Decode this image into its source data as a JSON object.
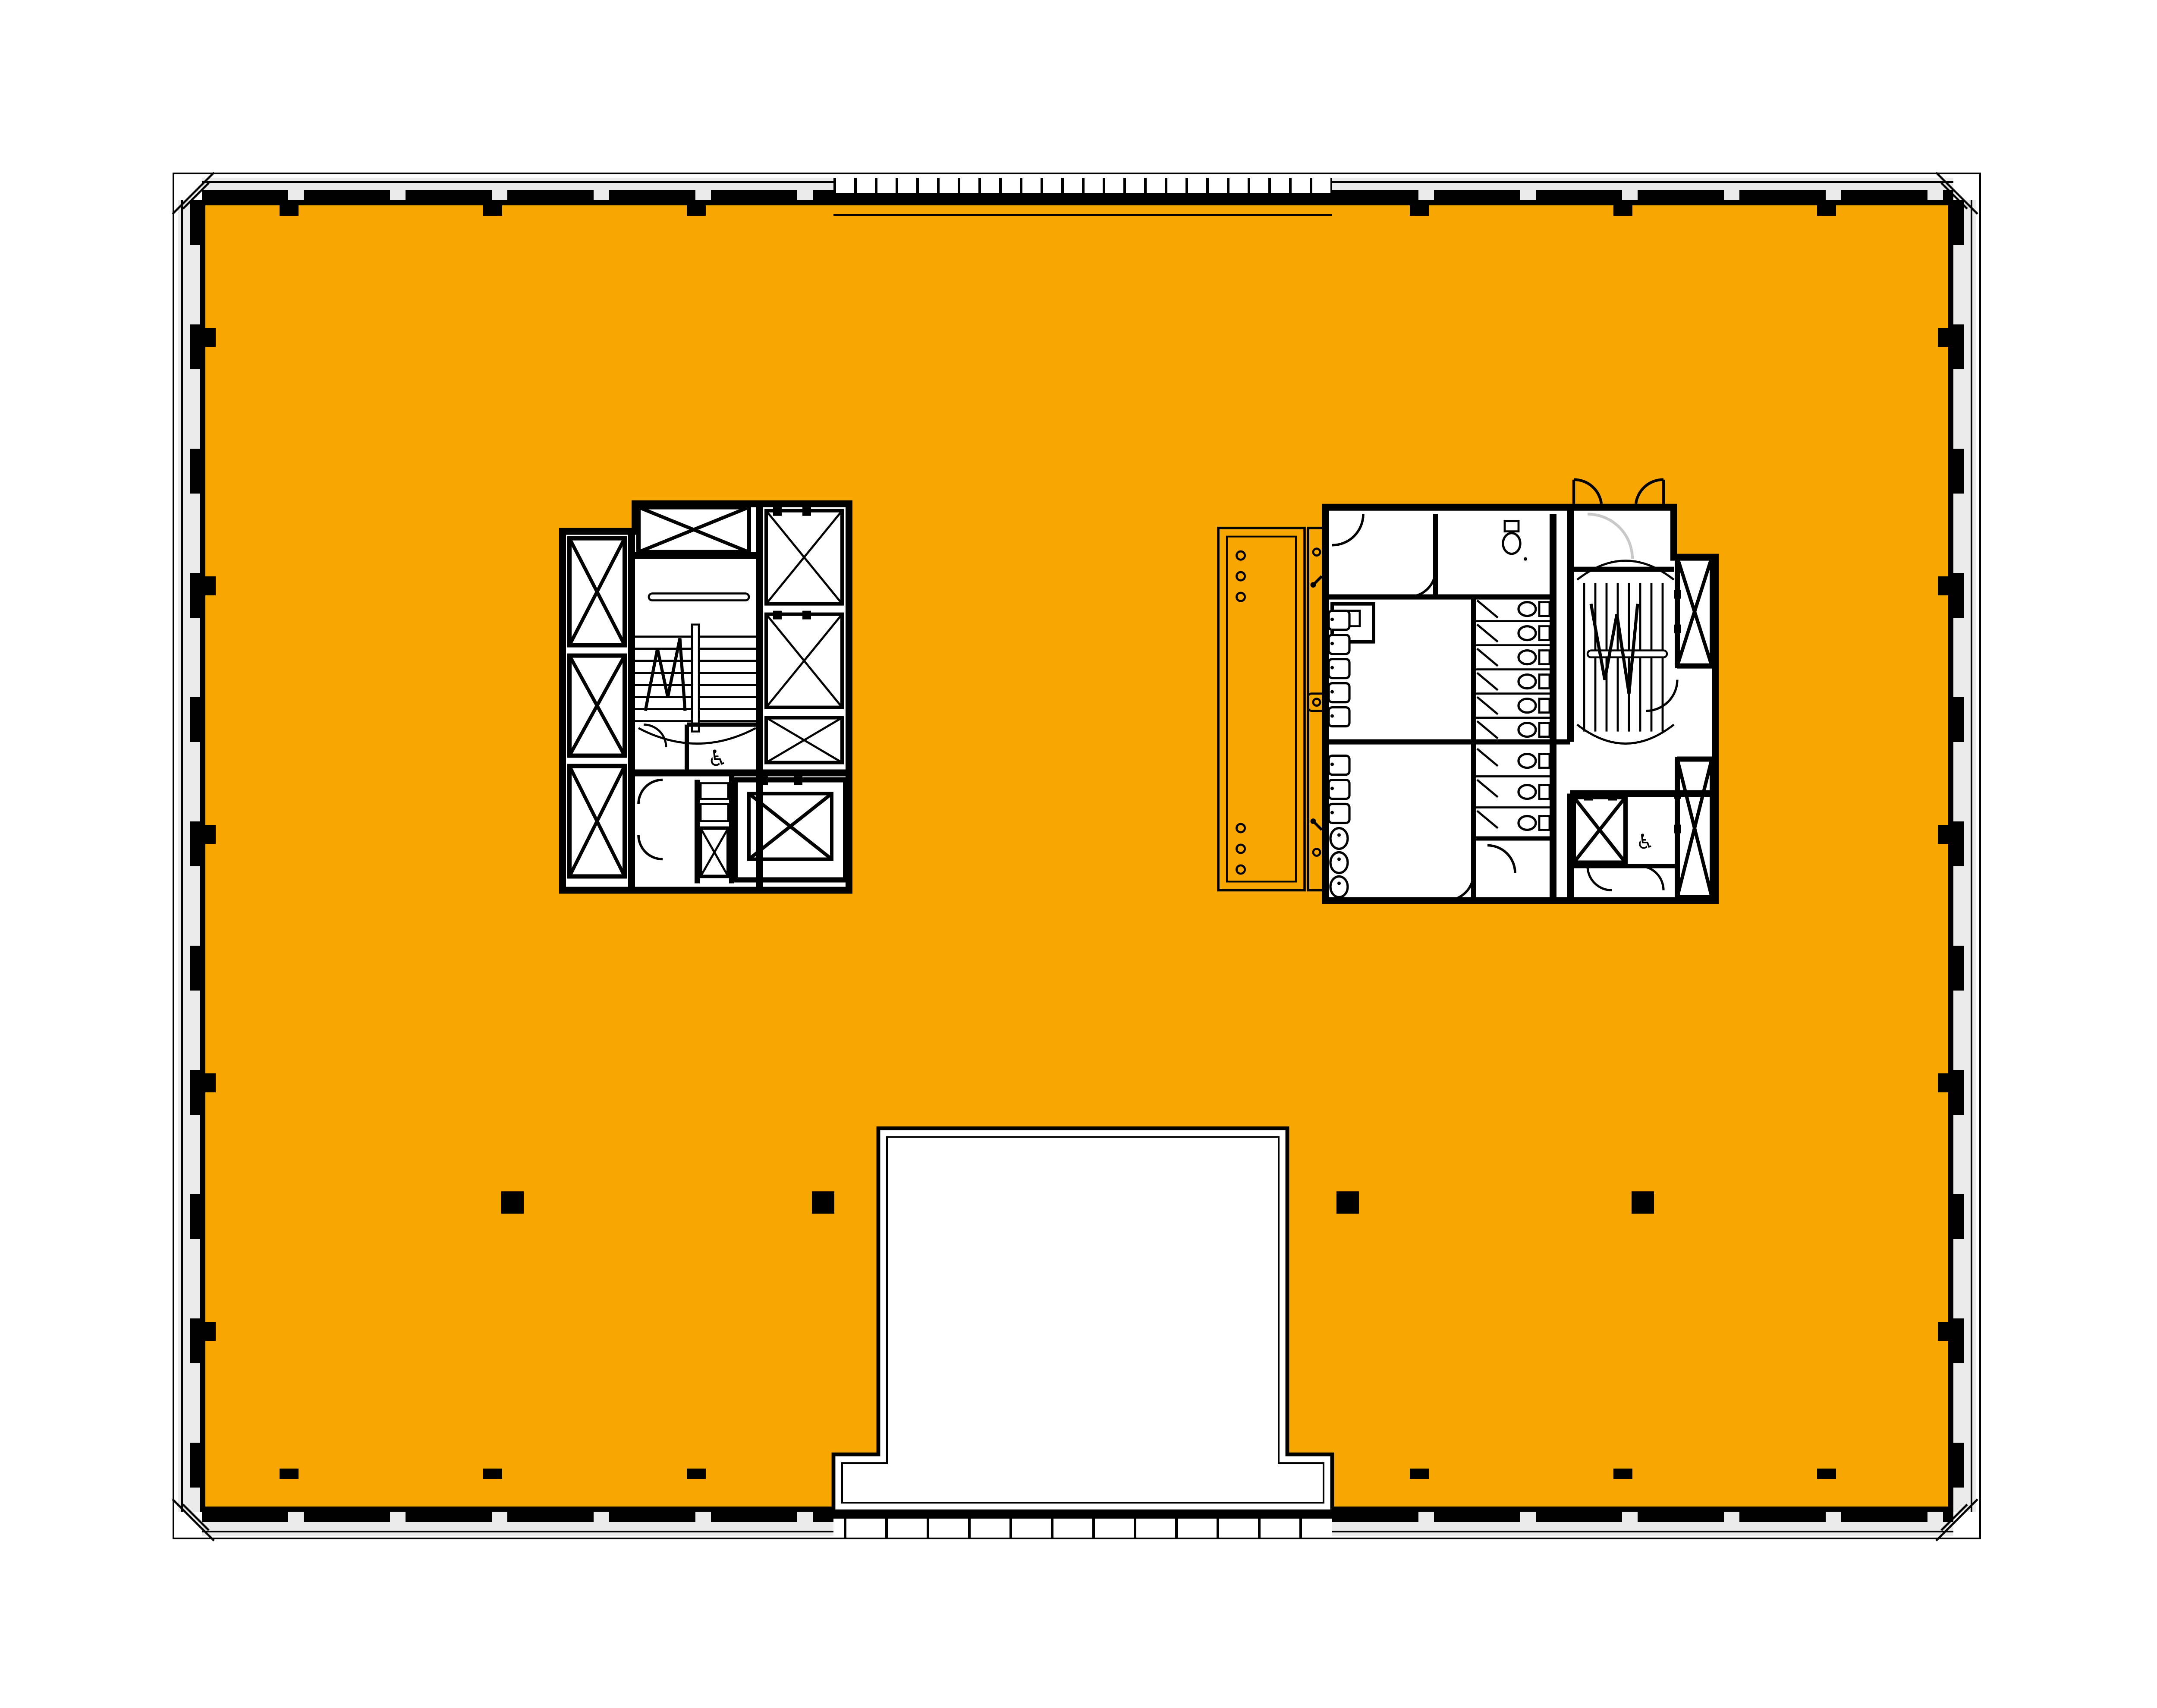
{
  "document": {
    "kind": "architectural-floor-plan",
    "visible_text": [],
    "description_of_pixels": "office tower typical floor plan, orange tenant slab, two service cores, south atrium void, glazed facade on four sides"
  },
  "palette": {
    "slab_orange": "#F8A602",
    "glass_gray": "#EBEBEB",
    "line_black": "#000000",
    "door_gray": "#C9C9C9",
    "white": "#FFFFFF"
  },
  "symbols": {
    "wheelchair": "♿"
  },
  "plan": {
    "cores": [
      {
        "id": "west-core",
        "features": [
          "stair",
          "3 shaft-x-boxes",
          "3 elevators",
          "accessible-wc",
          "service-elevator"
        ]
      },
      {
        "id": "east-core",
        "features": [
          "stair",
          "toilet-stalls",
          "sinks",
          "urinals",
          "accessible-wc",
          "2 elevator-shafts",
          "service-shaft",
          "bench-strip"
        ]
      }
    ],
    "structural_columns": 4,
    "atrium_void": {
      "position": "south-center",
      "shape": "stepped-rectangle"
    }
  }
}
